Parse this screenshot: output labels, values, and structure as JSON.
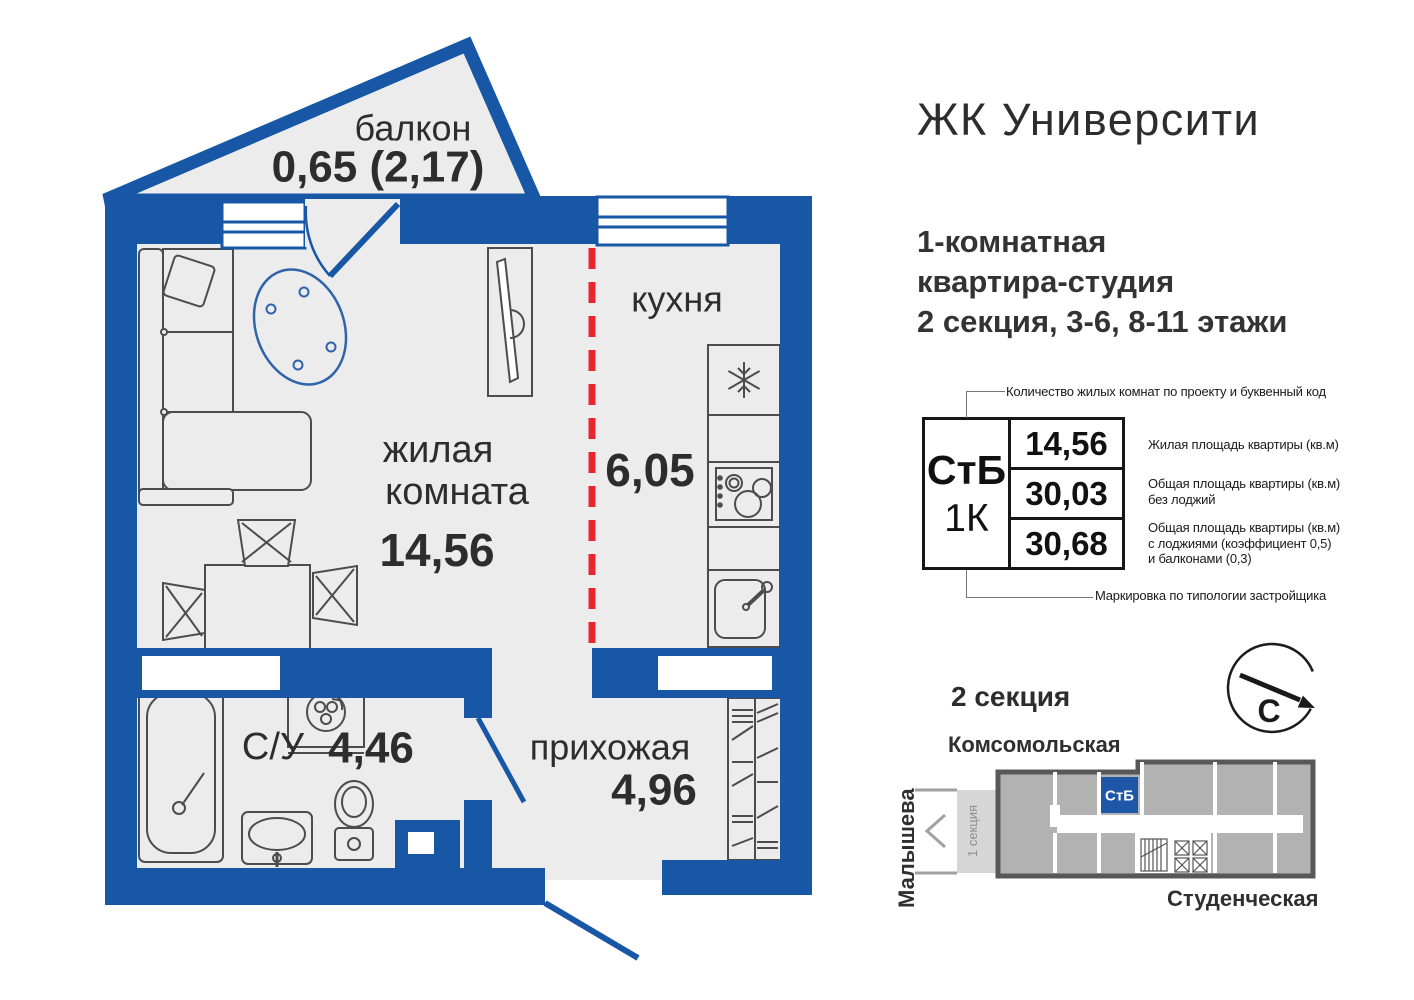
{
  "title": "ЖК Университи",
  "subtitle": {
    "lines": [
      "1-комнатная",
      "квартира-студия",
      "2 секция, 3-6, 8-11 этажи"
    ]
  },
  "plan": {
    "balcony": {
      "name": "балкон",
      "area": "0,65 (2,17)"
    },
    "living": {
      "name_lines": [
        "жилая",
        "комната"
      ],
      "area": "14,56"
    },
    "kitchen": {
      "name": "кухня",
      "area": "6,05"
    },
    "bathroom": {
      "name": "С/У",
      "area": "4,46"
    },
    "hallway": {
      "name": "прихожая",
      "area": "4,96"
    }
  },
  "spec": {
    "type_code": "СтБ",
    "rooms_code": "1К",
    "top_note": "Количество жилых комнат по проекту и буквенный код",
    "bottom_note": "Маркировка по типологии застройщика",
    "rows": [
      {
        "value": "14,56",
        "desc_lines": [
          "Жилая площадь квартиры (кв.м)",
          "",
          ""
        ]
      },
      {
        "value": "30,03",
        "desc_lines": [
          "Общая площадь квартиры (кв.м)",
          "без лоджий",
          ""
        ]
      },
      {
        "value": "30,68",
        "desc_lines": [
          "Общая площадь квартиры (кв.м)",
          "с лоджиями (коэффициент 0,5)",
          "и балконами (0,3)"
        ]
      }
    ]
  },
  "map": {
    "heading": "2 секция",
    "street_top": "Комсомольская",
    "street_left": "Малышева",
    "street_bottom": "Студенческая",
    "unit_label": "СтБ",
    "neighbor_label": "1 секция",
    "compass": "С"
  },
  "colors": {
    "wall_blue": "#1757a5",
    "floor_gray": "#ececed",
    "zone_red": "#e8262d",
    "ink": "#2d2d2d",
    "map_gray": "#b2b2b2",
    "map_outline": "#585858",
    "map_neighbor": "#d6d6d6"
  }
}
